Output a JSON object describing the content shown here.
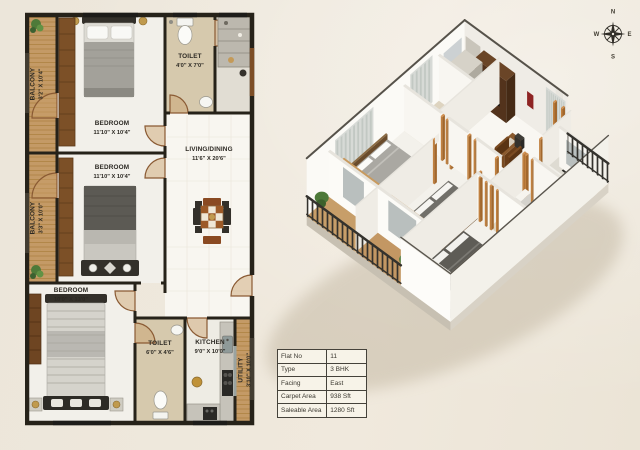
{
  "page": {
    "background": "#ece6da"
  },
  "plan2d": {
    "rooms": [
      {
        "id": "balcony-top",
        "name": "BALCONY",
        "dims": "3'2\" X 10'4\""
      },
      {
        "id": "bedroom-top",
        "name": "BEDROOM",
        "dims": "11'10\" X 10'4\""
      },
      {
        "id": "toilet-top",
        "name": "TOILET",
        "dims": "4'0\" X 7'0\""
      },
      {
        "id": "living-dining",
        "name": "LIVING/DINING",
        "dims": "11'6\" X 20'6\""
      },
      {
        "id": "balcony-mid",
        "name": "BALCONY",
        "dims": "3'3\" X 10'0\""
      },
      {
        "id": "bedroom-mid",
        "name": "BEDROOM",
        "dims": "11'10\" X 10'4\""
      },
      {
        "id": "bedroom-bottom",
        "name": "BEDROOM",
        "dims": "10'0\" X 13'0\""
      },
      {
        "id": "toilet-bottom",
        "name": "TOILET",
        "dims": "6'0\" X 4'6\""
      },
      {
        "id": "kitchen",
        "name": "KITCHEN",
        "dims": "9'0\" X 10'0\""
      },
      {
        "id": "utility",
        "name": "UTILITY",
        "dims": "3'10\" X 10'0\""
      }
    ]
  },
  "info_table": {
    "rows": [
      {
        "label": "Flat No",
        "value": "11"
      },
      {
        "label": "Type",
        "value": "3 BHK"
      },
      {
        "label": "Facing",
        "value": "East"
      },
      {
        "label": "Carpet Area",
        "value": "938 Sft"
      },
      {
        "label": "Saleable Area",
        "value": "1280 Sft"
      }
    ]
  },
  "compass": {
    "north": "N",
    "east": "E",
    "south": "S",
    "west": "W"
  },
  "colors": {
    "balcony_wood": "#c49a66",
    "wall_dark": "#262219",
    "door_wood": "#8a5a33",
    "accent_wood": "#c0803f",
    "railing": "#34322d"
  }
}
